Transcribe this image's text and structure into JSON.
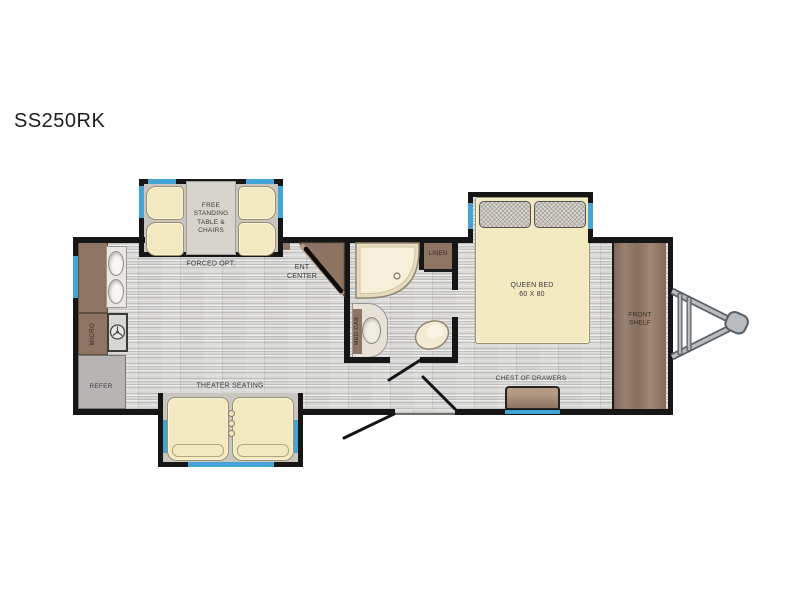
{
  "model": "SS250RK",
  "plan": {
    "dinette": {
      "label": "FREE\nSTANDING\nTABLE &\nCHAIRS",
      "option_note": "FORCED OPT."
    },
    "kitchen": {
      "micro": "MICRO",
      "refer": "REFER"
    },
    "living": {
      "theater": "THEATER SEATING",
      "ent_center": "ENT\nCENTER",
      "pantry": "PANTRY"
    },
    "bath": {
      "shower": "34' SHOWER",
      "linen": "LINEN",
      "med_cab": "MED CAB"
    },
    "bedroom": {
      "bed": "QUEEN BED\n60 X 80",
      "chest": "CHEST OF DRAWERS",
      "front_shelf": "FRONT\nSHELF"
    }
  },
  "colors": {
    "wall": "#161616",
    "window_accent": "#43a5d6",
    "cabinet_brown": "#8d7463",
    "upholstery_cream": "#f3e9c1",
    "floor_gray": "#d7d6d4",
    "slide_gray": "#c9c6c1"
  }
}
